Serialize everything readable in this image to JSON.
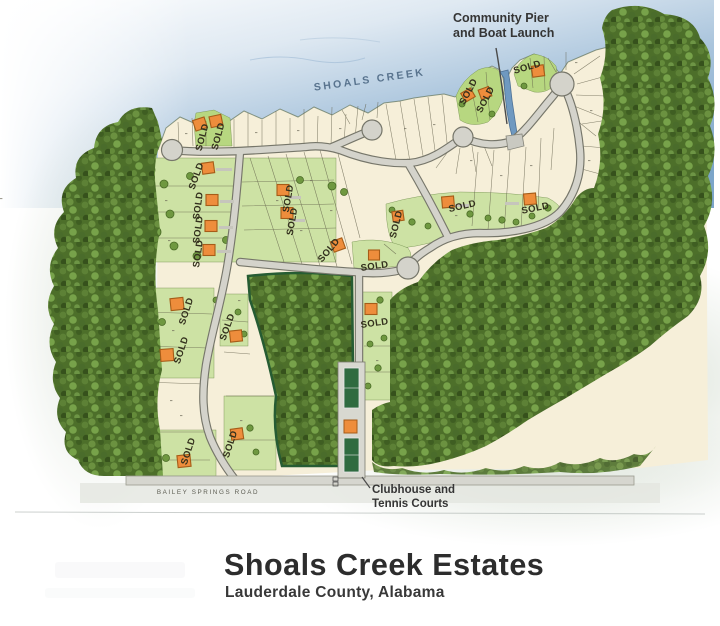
{
  "map": {
    "water_label": "SHOALS CREEK",
    "pier_annotation": {
      "line1": "Community Pier",
      "line2": "and Boat Launch"
    },
    "clubhouse_annotation": {
      "line1": "Clubhouse and",
      "line2": "Tennis Courts"
    },
    "bottom_road_label": "BAILEY SPRINGS ROAD",
    "sold_label": "SOLD",
    "sold_marker_count": 22,
    "features": [
      "water",
      "waterfront lots",
      "cul-de-sacs",
      "forest",
      "clubhouse",
      "tennis courts",
      "boat launch channel"
    ],
    "colors": {
      "water_deep": "#7ca5c9",
      "water_light": "#e6eef6",
      "lot_fill": "#f6efd9",
      "lot_line": "#5d5a45",
      "lawn": "#cde2a4",
      "lawn_bright": "#b7d780",
      "forest_base": "#4d6f2a",
      "road_fill": "#d4d3cb",
      "road_edge": "#76766a",
      "tennis_court": "#2f6b40",
      "house": "#ee8d3c",
      "house_edge": "#a65c18",
      "sold_text": "#33301d",
      "annotation_text": "#353535",
      "title_text": "#2d2d2d"
    }
  },
  "title": {
    "heading": "Shoals Creek Estates",
    "subheading": "Lauderdale County, Alabama"
  }
}
